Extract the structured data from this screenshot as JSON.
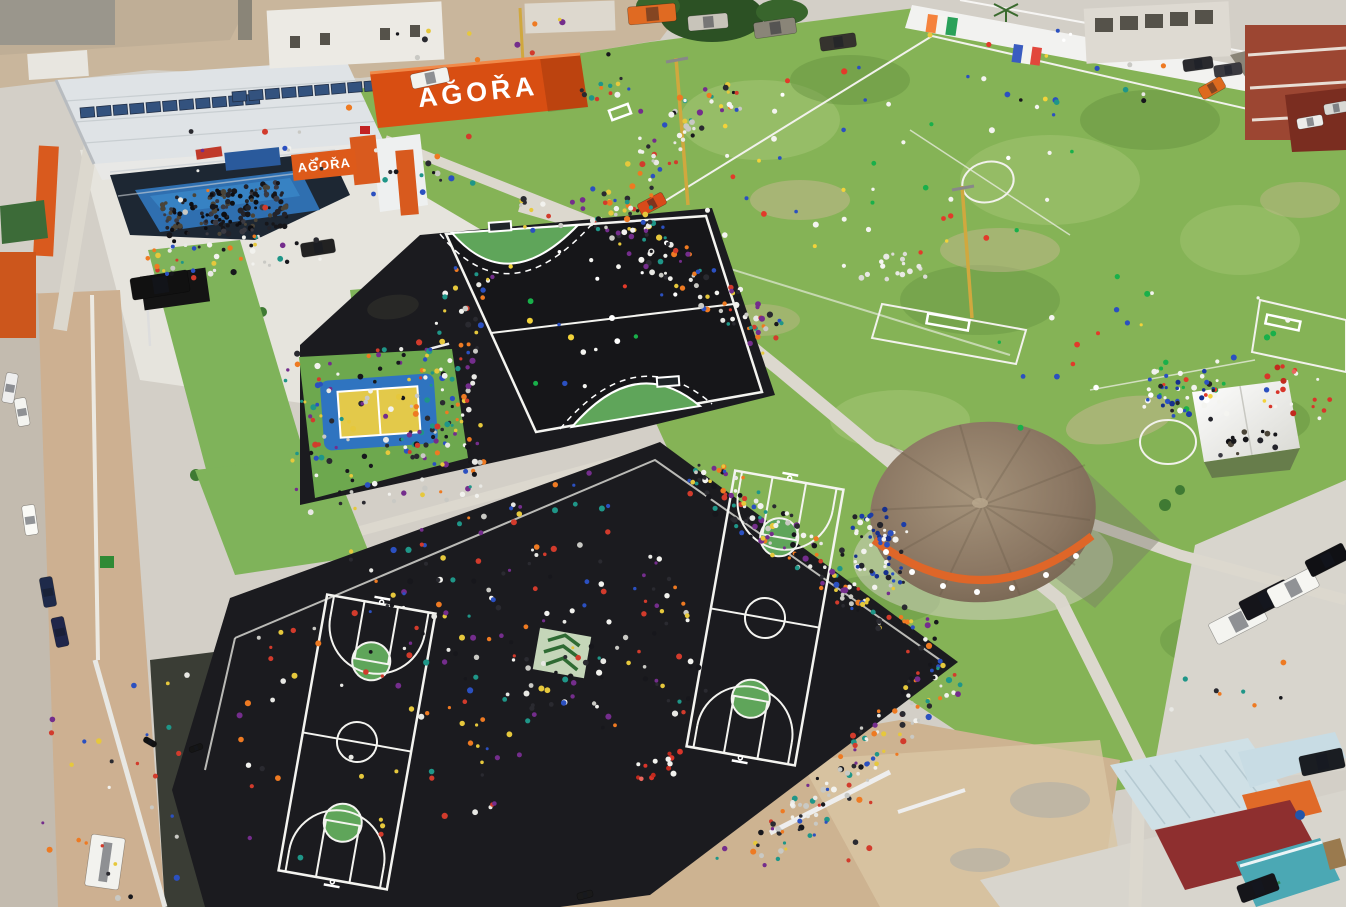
{
  "scene": {
    "title": "Aerial view of AGORA community sports complex on event day",
    "signs": {
      "container_sign": "AĞOŘA",
      "building_sign": "AĞOŘA"
    },
    "flags": [
      {
        "name": "cote-divoire-flag",
        "colors": [
          "#f5823c",
          "#f4f4ef",
          "#2aa159"
        ]
      },
      {
        "name": "france-flag",
        "colors": [
          "#3a5cc0",
          "#f4f4ef",
          "#e2473c"
        ]
      }
    ],
    "areas": [
      "agora-hall",
      "container-sign",
      "handball-court",
      "volleyball-court",
      "basketball-court-left",
      "basketball-court-right",
      "soccer-field-a",
      "soccer-field-b",
      "thatched-pavilion",
      "canopy-tent",
      "parking-lot",
      "access-road",
      "boundary-wall",
      "industrial-yard"
    ],
    "palette": {
      "grass": "#85b356",
      "asphalt": "#1b1b1f",
      "court_green": "#5fa55a",
      "agora_orange": "#dd5a1a",
      "volleyball_yellow": "#e3c94a",
      "volleyball_blue": "#2f74c0",
      "concrete": "#d3cfc7",
      "dirt": "#cdb391",
      "thatch_roof": "#8a7662",
      "solar_panel": "#33527e",
      "pale_roof": "#cfe0e6",
      "dark_red_building": "#8e2f2f"
    }
  },
  "crowds": {
    "palettes": {
      "dark": [
        "#16161a",
        "#23232a",
        "#3a3a42",
        "#0e0e12",
        "#4a4438"
      ],
      "mixed": [
        "#17171c",
        "#f2f2ee",
        "#d23b2c",
        "#2b50c0",
        "#e6c83c",
        "#e8e8e4",
        "#742d8c",
        "#1f9688",
        "#ee7a22",
        "#2a2a30",
        "#c9c9c4"
      ],
      "sport": [
        "#f4f4f0",
        "#e23a2a",
        "#2b50c0",
        "#f4f4f0",
        "#19b04a",
        "#f2d33a",
        "#ffffff"
      ],
      "white": [
        "#f6f6f2",
        "#e9e9e4",
        "#dcdcd6"
      ],
      "blue": [
        "#2b50c0",
        "#1c3da8",
        "#16308e",
        "#f2f2ee",
        "#23232a"
      ],
      "red": [
        "#d8352a",
        "#c22a1e",
        "#f2f2ee",
        "#e8675e"
      ]
    },
    "clusters": [
      {
        "name": "stage-crowd",
        "cx": 225,
        "cy": 212,
        "w": 125,
        "h": 45,
        "rot": -8,
        "n": 150,
        "palette": "dark"
      },
      {
        "name": "hall-front-crowd",
        "cx": 235,
        "cy": 255,
        "w": 190,
        "h": 35,
        "rot": -8,
        "n": 45,
        "palette": "mixed"
      },
      {
        "name": "plaza-walkers",
        "cx": 330,
        "cy": 160,
        "w": 320,
        "h": 100,
        "rot": -8,
        "n": 30,
        "palette": "mixed"
      },
      {
        "name": "volleyball-crowd",
        "cx": 383,
        "cy": 425,
        "w": 195,
        "h": 165,
        "rot": -5,
        "n": 140,
        "palette": "mixed"
      },
      {
        "name": "handball-west-crowd",
        "cx": 452,
        "cy": 355,
        "w": 55,
        "h": 220,
        "rot": 14,
        "n": 70,
        "palette": "mixed"
      },
      {
        "name": "handball-players",
        "cx": 600,
        "cy": 315,
        "w": 170,
        "h": 140,
        "rot": -8,
        "n": 22,
        "palette": "sport"
      },
      {
        "name": "path-crowd",
        "cx": 683,
        "cy": 270,
        "w": 230,
        "h": 42,
        "rot": 38,
        "n": 110,
        "palette": "mixed"
      },
      {
        "name": "fields-west-crowd",
        "cx": 652,
        "cy": 172,
        "w": 55,
        "h": 130,
        "rot": 12,
        "n": 45,
        "palette": "mixed"
      },
      {
        "name": "fields-corner-crowd",
        "cx": 702,
        "cy": 108,
        "w": 85,
        "h": 40,
        "rot": -28,
        "n": 30,
        "palette": "mixed"
      },
      {
        "name": "fieldA-players",
        "cx": 900,
        "cy": 160,
        "w": 400,
        "h": 210,
        "rot": -10,
        "n": 55,
        "palette": "sport"
      },
      {
        "name": "fieldB-players",
        "cx": 1150,
        "cy": 335,
        "w": 340,
        "h": 190,
        "rot": -10,
        "n": 30,
        "palette": "sport"
      },
      {
        "name": "fieldB-group",
        "cx": 1190,
        "cy": 392,
        "w": 90,
        "h": 40,
        "rot": 8,
        "n": 22,
        "palette": "sport"
      },
      {
        "name": "fieldA-group",
        "cx": 890,
        "cy": 268,
        "w": 70,
        "h": 28,
        "rot": -8,
        "n": 16,
        "palette": "white"
      },
      {
        "name": "court-edge-crowd-ne",
        "cx": 815,
        "cy": 558,
        "w": 300,
        "h": 46,
        "rot": 36,
        "n": 150,
        "palette": "mixed"
      },
      {
        "name": "court-edge-crowd-se",
        "cx": 855,
        "cy": 765,
        "w": 270,
        "h": 46,
        "rot": -45,
        "n": 120,
        "palette": "mixed"
      },
      {
        "name": "asphalt-center-crowd",
        "cx": 570,
        "cy": 655,
        "w": 250,
        "h": 170,
        "rot": -15,
        "n": 120,
        "palette": "mixed"
      },
      {
        "name": "courtL-scatter",
        "cx": 350,
        "cy": 730,
        "w": 270,
        "h": 250,
        "rot": -15,
        "n": 55,
        "palette": "mixed"
      },
      {
        "name": "asphalt-north-scatter",
        "cx": 480,
        "cy": 545,
        "w": 290,
        "h": 70,
        "rot": -18,
        "n": 45,
        "palette": "mixed"
      },
      {
        "name": "pavilion-crowd",
        "cx": 880,
        "cy": 545,
        "w": 55,
        "h": 75,
        "rot": 0,
        "n": 55,
        "palette": "blue"
      },
      {
        "name": "tent-crowd",
        "cx": 1248,
        "cy": 442,
        "w": 70,
        "h": 25,
        "rot": -6,
        "n": 14,
        "palette": "dark"
      },
      {
        "name": "tent-west-crowd",
        "cx": 1182,
        "cy": 396,
        "w": 70,
        "h": 52,
        "rot": 0,
        "n": 30,
        "palette": "blue"
      },
      {
        "name": "red-kids",
        "cx": 1305,
        "cy": 392,
        "w": 80,
        "h": 55,
        "rot": 0,
        "n": 18,
        "palette": "red"
      },
      {
        "name": "red-kids-bottom",
        "cx": 648,
        "cy": 768,
        "w": 70,
        "h": 28,
        "rot": -10,
        "n": 14,
        "palette": "red"
      },
      {
        "name": "road-pedestrians",
        "cx": 115,
        "cy": 785,
        "w": 150,
        "h": 230,
        "rot": 0,
        "n": 28,
        "palette": "mixed"
      },
      {
        "name": "plaza-path-walkers",
        "cx": 556,
        "cy": 208,
        "w": 90,
        "h": 40,
        "rot": -15,
        "n": 14,
        "palette": "mixed"
      },
      {
        "name": "sign-people",
        "cx": 600,
        "cy": 90,
        "w": 60,
        "h": 28,
        "rot": -8,
        "n": 12,
        "palette": "mixed"
      },
      {
        "name": "parking-walkers",
        "cx": 1235,
        "cy": 700,
        "w": 130,
        "h": 60,
        "rot": -10,
        "n": 8,
        "palette": "mixed"
      },
      {
        "name": "dirt-walkers",
        "cx": 820,
        "cy": 835,
        "w": 230,
        "h": 80,
        "rot": -8,
        "n": 10,
        "palette": "mixed"
      },
      {
        "name": "top-yard-workers",
        "cx": 520,
        "cy": 40,
        "w": 260,
        "h": 50,
        "rot": 0,
        "n": 12,
        "palette": "mixed"
      },
      {
        "name": "street-people-tr",
        "cx": 1100,
        "cy": 90,
        "w": 180,
        "h": 50,
        "rot": -12,
        "n": 10,
        "palette": "mixed"
      }
    ]
  },
  "cars": [
    {
      "name": "pickup-white-yard",
      "x": 430,
      "y": 78,
      "w": 38,
      "h": 15,
      "rot": -12,
      "color": "#f2f2ee"
    },
    {
      "name": "truck-orange-yard",
      "x": 652,
      "y": 14,
      "w": 48,
      "h": 18,
      "rot": -5,
      "color": "#e06a22"
    },
    {
      "name": "truck-gray-yard",
      "x": 708,
      "y": 22,
      "w": 40,
      "h": 15,
      "rot": -5,
      "color": "#c8c4ba"
    },
    {
      "name": "truck-dark-yard",
      "x": 775,
      "y": 28,
      "w": 42,
      "h": 16,
      "rot": -8,
      "color": "#8a8578"
    },
    {
      "name": "truck-black-yard",
      "x": 838,
      "y": 42,
      "w": 36,
      "h": 14,
      "rot": -8,
      "color": "#35332e"
    },
    {
      "name": "suv-black-plaza",
      "x": 160,
      "y": 285,
      "w": 58,
      "h": 22,
      "rot": -9,
      "color": "#111111"
    },
    {
      "name": "car-dark-plaza",
      "x": 318,
      "y": 248,
      "w": 34,
      "h": 14,
      "rot": -9,
      "color": "#222222"
    },
    {
      "name": "car-orange-path",
      "x": 652,
      "y": 204,
      "w": 28,
      "h": 13,
      "rot": -28,
      "color": "#d84a1a"
    },
    {
      "name": "car-white-road-1",
      "x": 10,
      "y": 388,
      "w": 30,
      "h": 12,
      "rot": 100,
      "color": "#eeeeee"
    },
    {
      "name": "car-white-road-2",
      "x": 22,
      "y": 412,
      "w": 28,
      "h": 12,
      "rot": 80,
      "color": "#f4f4f0"
    },
    {
      "name": "car-white-road-3",
      "x": 30,
      "y": 520,
      "w": 30,
      "h": 13,
      "rot": 82,
      "color": "#fafaf6"
    },
    {
      "name": "car-blue-road-1",
      "x": 48,
      "y": 592,
      "w": 30,
      "h": 13,
      "rot": 80,
      "color": "#1e2a4a"
    },
    {
      "name": "car-blue-road-2",
      "x": 60,
      "y": 632,
      "w": 30,
      "h": 13,
      "rot": 78,
      "color": "#20264a"
    },
    {
      "name": "van-white-road",
      "x": 105,
      "y": 862,
      "w": 34,
      "h": 52,
      "rot": 8,
      "color": "#f2f2ee"
    },
    {
      "name": "van-white-parking-1",
      "x": 1238,
      "y": 622,
      "w": 56,
      "h": 23,
      "rot": -27,
      "color": "#f4f4f0"
    },
    {
      "name": "sedan-black-parking",
      "x": 1266,
      "y": 600,
      "w": 52,
      "h": 21,
      "rot": -27,
      "color": "#15151a"
    },
    {
      "name": "van-white-parking-2",
      "x": 1293,
      "y": 588,
      "w": 50,
      "h": 21,
      "rot": -27,
      "color": "#f6f6f2"
    },
    {
      "name": "car-black-parking",
      "x": 1327,
      "y": 560,
      "w": 42,
      "h": 18,
      "rot": -27,
      "color": "#101014"
    },
    {
      "name": "suv-dark-southeast",
      "x": 1322,
      "y": 762,
      "w": 44,
      "h": 20,
      "rot": -12,
      "color": "#1a1d22"
    },
    {
      "name": "car-black-bottom",
      "x": 1258,
      "y": 888,
      "w": 40,
      "h": 18,
      "rot": -20,
      "color": "#15151a"
    },
    {
      "name": "car-dark-street-1",
      "x": 1198,
      "y": 64,
      "w": 30,
      "h": 12,
      "rot": -8,
      "color": "#2a2a2e"
    },
    {
      "name": "car-dark-street-2",
      "x": 1228,
      "y": 70,
      "w": 28,
      "h": 12,
      "rot": -8,
      "color": "#3a3a40"
    },
    {
      "name": "van-orange-street",
      "x": 1212,
      "y": 88,
      "w": 26,
      "h": 13,
      "rot": -30,
      "color": "#dd6a1e"
    },
    {
      "name": "car-white-street-1",
      "x": 1310,
      "y": 122,
      "w": 26,
      "h": 11,
      "rot": -10,
      "color": "#ececea"
    },
    {
      "name": "car-white-street-2",
      "x": 1336,
      "y": 108,
      "w": 24,
      "h": 11,
      "rot": -10,
      "color": "#d8d8d4"
    },
    {
      "name": "motorbike-1",
      "x": 150,
      "y": 742,
      "w": 14,
      "h": 6,
      "rot": 30,
      "color": "#111111"
    },
    {
      "name": "motorbike-2",
      "x": 196,
      "y": 748,
      "w": 14,
      "h": 6,
      "rot": -20,
      "color": "#151515"
    },
    {
      "name": "bicycle-court",
      "x": 585,
      "y": 895,
      "w": 16,
      "h": 7,
      "rot": -15,
      "color": "#1a1a1a"
    }
  ],
  "flag_layout": [
    {
      "x": 928,
      "y": 14,
      "w": 30,
      "h": 18,
      "rot": 8
    },
    {
      "x": 1014,
      "y": 44,
      "w": 28,
      "h": 18,
      "rot": 8
    }
  ]
}
